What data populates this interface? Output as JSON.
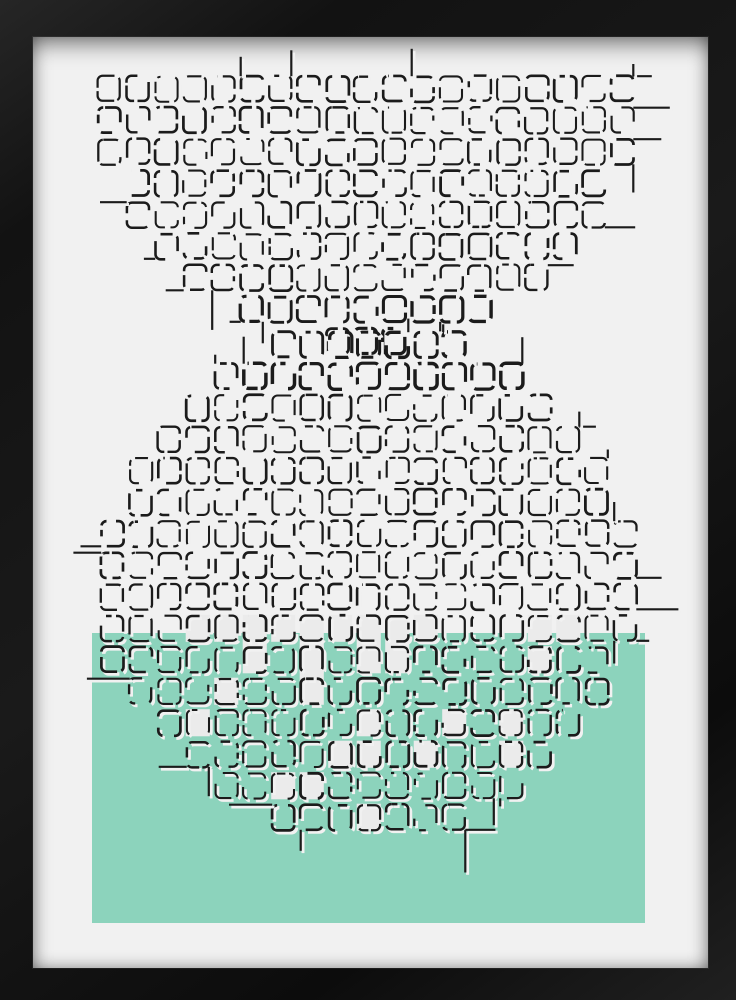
{
  "artwork": {
    "kind": "framed-abstract-grid-print",
    "canvas": {
      "width": 736,
      "height": 1000
    },
    "frame": {
      "left": 33,
      "top": 37,
      "right": 28,
      "bottom": 32
    },
    "colors": {
      "frame": "#161616",
      "matte": "#f1f1f1",
      "line": "#1b1b1b",
      "casing": "#f1f1f1",
      "accent_green": "#8cd3bc",
      "white_cell": "#ebebeb"
    },
    "shapes": {
      "semicircle": {
        "cx": 367.5,
        "cy": 73,
        "r": 272.5,
        "grid_origin": [
          95,
          73
        ],
        "cols": 20,
        "rows": 10
      },
      "circle": {
        "cx": 367,
        "cy": 582,
        "rx": 268,
        "ry": 253,
        "grid_origin": [
          98,
          329
        ],
        "cols": 20,
        "rows": 18
      },
      "green_rect": {
        "x": 92,
        "y": 633,
        "width": 553,
        "height": 290
      }
    },
    "grid": {
      "col_period": 28.5,
      "row_period": 31.5,
      "inset": 3.2,
      "corner_radius": 5,
      "casing_offset": 2.3
    },
    "generator": {
      "seed": 7,
      "jitter": 1.2,
      "stroke_min": 2.0,
      "stroke_var": 0.8,
      "bold_extra": 0.7,
      "dash": {
        "min": 5,
        "max": 30,
        "gap_small": [
          2.5,
          7
        ],
        "gap_large": [
          7,
          22
        ],
        "sparse_prob": 0.12
      },
      "tail": {
        "prob_h": 0.3,
        "prob_v": 0.22,
        "len_min": 8,
        "len_max": 46
      },
      "white_cells": {
        "prob": 0.3,
        "double_prob": 0.3
      },
      "bold_zone_a_y": 286,
      "bold_zone_b_y": 380
    }
  }
}
